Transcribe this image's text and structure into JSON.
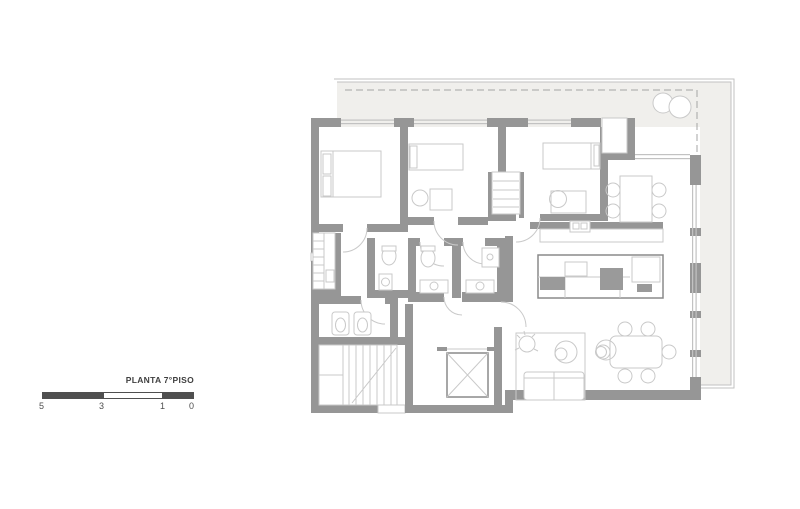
{
  "legend": {
    "title": "PLANTA 7°PISO",
    "ticks": [
      "5",
      "3",
      "1",
      "0"
    ]
  },
  "colors": {
    "wall": "#969696",
    "terrace": "#f0efec",
    "line": "#c9c9c9",
    "dark": "#4f4f4f",
    "appliance": "#9a9a9a",
    "text": "#3f3f3f",
    "window": "#c2c2c2",
    "dash": "#a5a5a5"
  }
}
